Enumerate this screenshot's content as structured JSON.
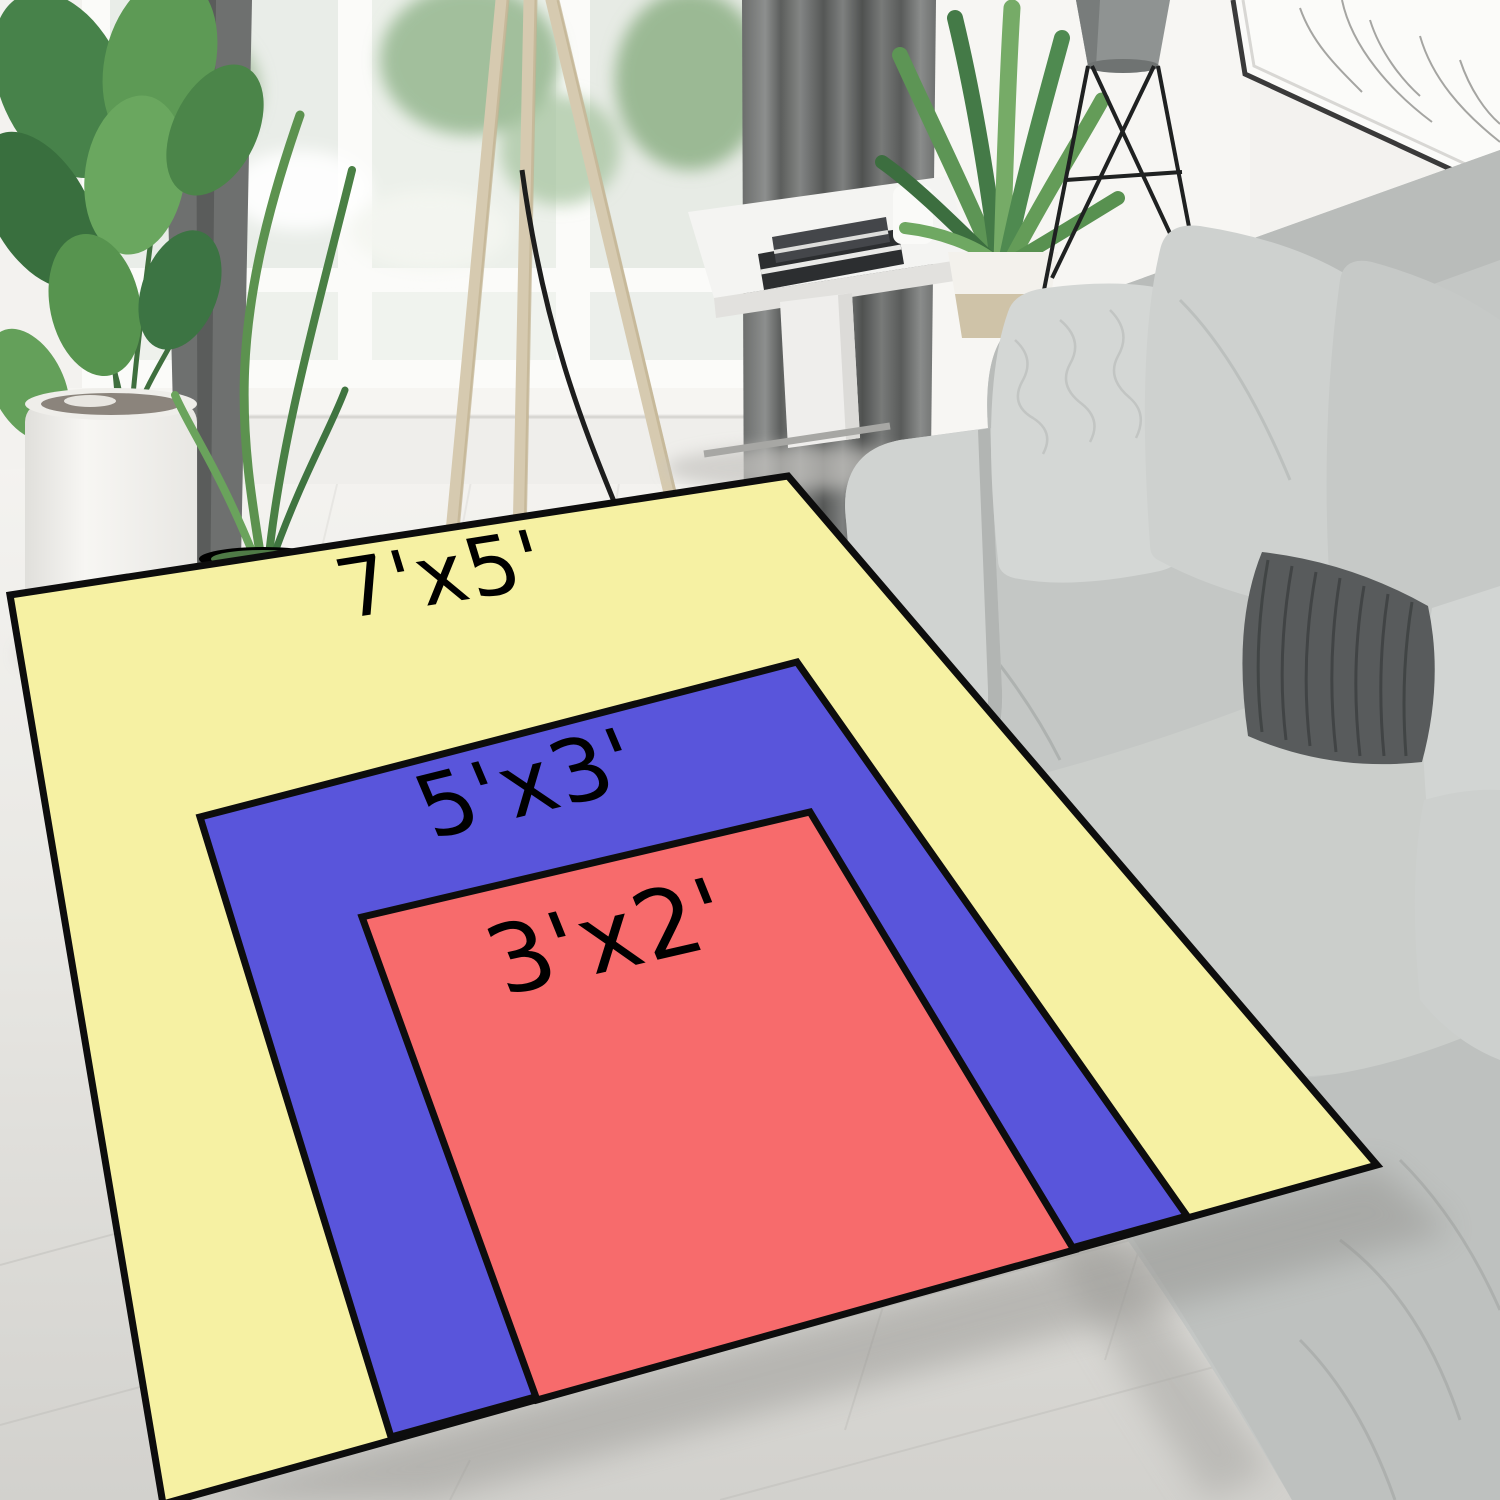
{
  "rug_size_comparison": {
    "border_color": "#0d0d0d",
    "label_color": "#000000",
    "rugs": [
      {
        "name": "7x5-rug",
        "size_label": "7'x5'",
        "fill": "#f6f1a3",
        "points": "10,595 788,476 1377,1165 163,1504",
        "label_transform": "translate(450 602) rotate(-9) skewX(8)",
        "label_font_size": "82"
      },
      {
        "name": "5x3-rug",
        "size_label": "5'x3'",
        "fill": "#5955db",
        "points": "200,817 797,662 1187,1216 391,1437",
        "label_transform": "translate(540 812) rotate(-14) skewX(9)",
        "label_font_size": "88"
      },
      {
        "name": "3x2-rug",
        "size_label": "3'x2'",
        "fill": "#f76b6c",
        "points": "362,917 810,812 1074,1250 537,1400",
        "label_transform": "translate(622 968) rotate(-13) skewX(9)",
        "label_font_size": "96"
      }
    ]
  }
}
